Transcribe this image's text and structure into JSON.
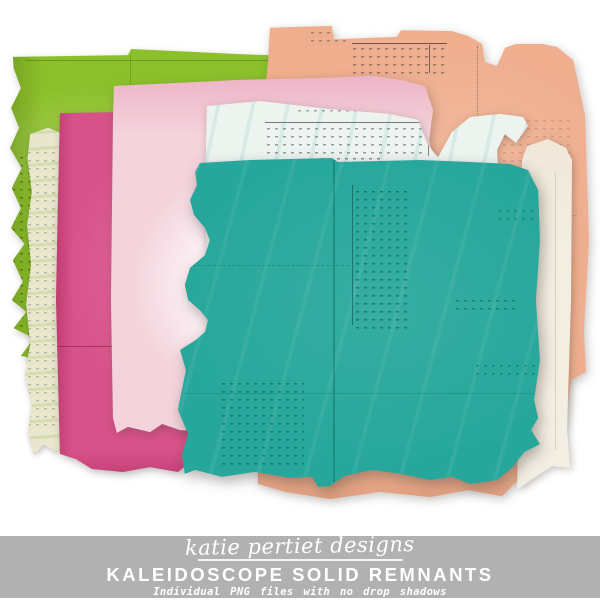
{
  "canvas": {
    "background": "#ffffff",
    "width": 600,
    "height": 600
  },
  "papers": [
    {
      "id": "green",
      "name": "green solid remnant",
      "color": "#8cc02b"
    },
    {
      "id": "peach",
      "name": "peach solid remnant",
      "color": "#efae8e"
    },
    {
      "id": "cream",
      "name": "cream solid remnant",
      "color": "#e9e6ce"
    },
    {
      "id": "magenta",
      "name": "magenta solid remnant",
      "color": "#d8528a"
    },
    {
      "id": "lightpink",
      "name": "light pink solid remnant",
      "color": "#f4d3dc"
    },
    {
      "id": "whiteblue",
      "name": "white-teal solid remnant",
      "color": "#edf4f0"
    },
    {
      "id": "whiteright",
      "name": "ivory solid remnant",
      "color": "#f3eee2"
    },
    {
      "id": "teal",
      "name": "teal solid remnant",
      "color": "#27a79b"
    }
  ],
  "branding": {
    "script_name": "katie pertiet designs",
    "product_title": "KALEIDOSCOPE SOLID REMNANTS",
    "subtitle": "Individual PNG files with no drop shadows",
    "banner_bg": "#b1b1b1",
    "text_color": "#ffffff"
  }
}
